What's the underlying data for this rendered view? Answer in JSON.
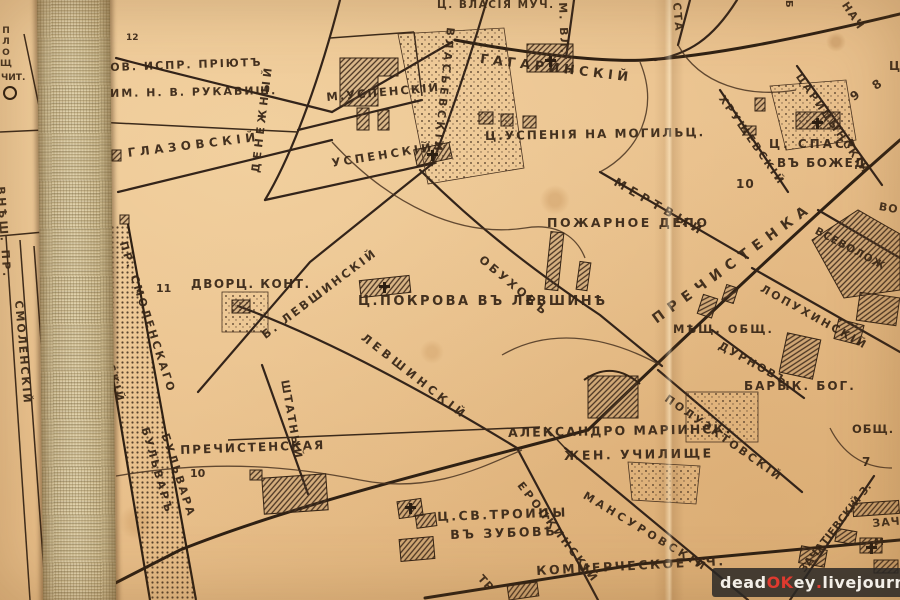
{
  "map": {
    "kind": "historical-city-map-scan",
    "ink_color": "#32230f",
    "paper_color": "#e9c08c",
    "cloth_color": "#cdbb91",
    "labels": [
      {
        "n": "street-label-gagarinsky",
        "t": "ГАГАРИНСКІЙ",
        "x": 481,
        "y": 53,
        "r": 7,
        "s": 13,
        "sp": 4.5
      },
      {
        "n": "church-label-vlasiya",
        "t": "Ц. ВЛАСІЯ МУЧ.",
        "x": 437,
        "y": 0,
        "r": 0,
        "s": 10.5,
        "sp": 1.5
      },
      {
        "n": "street-label-vlasyevsky",
        "t": "ВЛАСЬЕВСКІЙ",
        "x": 456,
        "y": 28,
        "r": 96,
        "s": 11,
        "sp": 3.5
      },
      {
        "n": "street-label-m-vlasyevsky",
        "t": "М. ВЛ.",
        "x": 568,
        "y": 2,
        "r": 88,
        "s": 11,
        "sp": 2
      },
      {
        "n": "street-label-sta-partial",
        "t": "СТА",
        "x": 682,
        "y": 2,
        "r": 85,
        "s": 11,
        "sp": 2
      },
      {
        "n": "street-label-nach-partial",
        "t": "НАЧ",
        "x": 849,
        "y": 0,
        "r": 56,
        "s": 11,
        "sp": 1.5
      },
      {
        "n": "street-label-b-partial",
        "t": "Б",
        "x": 793,
        "y": 0,
        "r": 90,
        "s": 10,
        "sp": 0
      },
      {
        "n": "label-ts-partial",
        "t": "Ц",
        "x": 889,
        "y": 60,
        "r": 0,
        "s": 12,
        "sp": 0
      },
      {
        "n": "label-priyut-line1",
        "t": "ОВ. ИСПР. ПРІЮТЪ",
        "x": 110,
        "y": 62,
        "r": -2,
        "s": 11,
        "sp": 2
      },
      {
        "n": "label-priyut-line2",
        "t": "ИМ. Н. В. РУКАВИШ.",
        "x": 110,
        "y": 88,
        "r": -1,
        "s": 11,
        "sp": 2
      },
      {
        "n": "block-number-12",
        "t": "12",
        "x": 126,
        "y": 34,
        "r": 0,
        "s": 9,
        "sp": 0
      },
      {
        "n": "label-ploshch-partial",
        "t": "ПЛОЩ",
        "x": 1,
        "y": 26,
        "r": 0,
        "s": 9,
        "sp": 1,
        "up": true
      },
      {
        "n": "label-chit",
        "t": "ЧИТ.",
        "x": 1,
        "y": 74,
        "r": 0,
        "s": 9,
        "sp": 0
      },
      {
        "n": "street-label-glazovsky",
        "t": "ГЛАЗОВСКІЙ",
        "x": 127,
        "y": 147,
        "r": -7,
        "s": 12,
        "sp": 4.5
      },
      {
        "n": "street-label-denezhny",
        "t": "ДЕНЕЖНЫЙ",
        "x": 250,
        "y": 172,
        "r": -83,
        "s": 11,
        "sp": 4
      },
      {
        "n": "street-label-m-uspensky",
        "t": "М.УСПЕНСКІЙ",
        "x": 326,
        "y": 92,
        "r": -5,
        "s": 11.5,
        "sp": 2
      },
      {
        "n": "street-label-uspensky",
        "t": "УСПЕНСКІЙ",
        "x": 331,
        "y": 158,
        "r": -9,
        "s": 11.5,
        "sp": 3
      },
      {
        "n": "church-label-uspeniya",
        "t": "Ц.УСПЕНІЯ НА МОГИЛЬЦ.",
        "x": 485,
        "y": 130,
        "r": -1,
        "s": 12,
        "sp": 2
      },
      {
        "n": "street-label-tsaritsynsky",
        "t": "ЦАРИЦЫНСКІЙ",
        "x": 802,
        "y": 72,
        "r": 55,
        "s": 10.5,
        "sp": 2.5
      },
      {
        "n": "street-label-khrushchevsky",
        "t": "ХРУЩЕВСКІЙ",
        "x": 725,
        "y": 94,
        "r": 55,
        "s": 10.5,
        "sp": 2.5
      },
      {
        "n": "street-label-mertvy",
        "t": "МЕРТВЫЙ",
        "x": 618,
        "y": 176,
        "r": 30,
        "s": 12,
        "sp": 5
      },
      {
        "n": "church-label-spasa-line1",
        "t": "Ц. СПАСА",
        "x": 769,
        "y": 138,
        "r": 0,
        "s": 12,
        "sp": 3
      },
      {
        "n": "church-label-spasa-line2",
        "t": "ВЪ БОЖЕД.",
        "x": 777,
        "y": 157,
        "r": 0,
        "s": 12,
        "sp": 1.5
      },
      {
        "n": "block-number-10a",
        "t": "10",
        "x": 736,
        "y": 178,
        "r": 0,
        "s": 12,
        "sp": 1
      },
      {
        "n": "block-number-9",
        "t": "9",
        "x": 848,
        "y": 93,
        "r": -35,
        "s": 12,
        "sp": 0
      },
      {
        "n": "block-number-8",
        "t": "8",
        "x": 870,
        "y": 82,
        "r": -35,
        "s": 12,
        "sp": 0
      },
      {
        "n": "label-pozharnoe-depo",
        "t": "ПОЖАРНОЕ ДЕПО",
        "x": 547,
        "y": 217,
        "r": 0,
        "s": 12.5,
        "sp": 2.5
      },
      {
        "n": "street-label-obukhov",
        "t": "ОБУХОВЪ",
        "x": 484,
        "y": 254,
        "r": 40,
        "s": 11.5,
        "sp": 3
      },
      {
        "n": "street-label-prechistenka",
        "t": "ПРЕЧИСТЕНКА",
        "x": 650,
        "y": 315,
        "r": -36,
        "s": 14,
        "sp": 7
      },
      {
        "n": "street-label-vsevolozh",
        "t": "ВСЕВОЛОЖ",
        "x": 818,
        "y": 226,
        "r": 28,
        "s": 10.5,
        "sp": 1
      },
      {
        "n": "label-vo-partial",
        "t": "ВО",
        "x": 880,
        "y": 201,
        "r": 10,
        "s": 11,
        "sp": 1
      },
      {
        "n": "street-label-lopukhinsky",
        "t": "ЛОПУХИНСКІЙ",
        "x": 764,
        "y": 283,
        "r": 29,
        "s": 11,
        "sp": 2.5
      },
      {
        "n": "label-meshch-obshch",
        "t": "МѢЩ. ОБЩ.",
        "x": 673,
        "y": 324,
        "r": 0,
        "s": 11.5,
        "sp": 2
      },
      {
        "n": "street-label-durnov",
        "t": "ДУРНОВЪ",
        "x": 722,
        "y": 340,
        "r": 29,
        "s": 11,
        "sp": 2
      },
      {
        "n": "label-baryk-bog",
        "t": "БАРЫК. БОГ.",
        "x": 744,
        "y": 380,
        "r": 0,
        "s": 12,
        "sp": 2
      },
      {
        "n": "street-label-b-levshinsky",
        "t": "Б. ЛЕВШИНСКІЙ",
        "x": 260,
        "y": 332,
        "r": -37,
        "s": 11.5,
        "sp": 2.5
      },
      {
        "n": "label-dvorts-kont",
        "t": "ДВОРЦ. КОНТ.",
        "x": 191,
        "y": 278,
        "r": 0,
        "s": 12,
        "sp": 1.5
      },
      {
        "n": "block-number-11",
        "t": "11",
        "x": 156,
        "y": 283,
        "r": 0,
        "s": 11,
        "sp": 0
      },
      {
        "n": "church-label-pokrova",
        "t": "Ц.ПОКРОВА ВЪ ЛЕВШИНѢ",
        "x": 358,
        "y": 295,
        "r": 0,
        "s": 13,
        "sp": 2.5
      },
      {
        "n": "street-label-levshinsky",
        "t": "ЛЕВШИНСКІЙ",
        "x": 366,
        "y": 332,
        "r": 38,
        "s": 11.5,
        "sp": 4
      },
      {
        "n": "street-label-shtatny",
        "t": "ШТАТНЫЙ",
        "x": 290,
        "y": 379,
        "r": 80,
        "s": 11,
        "sp": 2
      },
      {
        "n": "label-prechistenskaya",
        "t": "ПРЕЧИСТЕНСКАЯ",
        "x": 180,
        "y": 444,
        "r": -2,
        "s": 12,
        "sp": 2
      },
      {
        "n": "block-number-10b",
        "t": "10",
        "x": 190,
        "y": 468,
        "r": 0,
        "s": 11,
        "sp": 0
      },
      {
        "n": "label-aleksandro-mariinsk",
        "t": "АЛЕКСАНДРО МАРІИНСК.",
        "x": 508,
        "y": 427,
        "r": -1,
        "s": 12.5,
        "sp": 2
      },
      {
        "n": "label-zhen-uchilishche",
        "t": "ЖЕН. УЧИЛИЩЕ",
        "x": 564,
        "y": 450,
        "r": -1,
        "s": 12.5,
        "sp": 2.5
      },
      {
        "n": "street-label-poluektovsky",
        "t": "ПОЛУЭКТОВСКІЙ",
        "x": 669,
        "y": 393,
        "r": 35,
        "s": 11,
        "sp": 2.5
      },
      {
        "n": "label-obshch-p-partial",
        "t": "ОБЩ. П",
        "x": 852,
        "y": 424,
        "r": 0,
        "s": 11.5,
        "sp": 1
      },
      {
        "n": "block-number-7",
        "t": "7",
        "x": 862,
        "y": 456,
        "r": 0,
        "s": 12,
        "sp": 0
      },
      {
        "n": "church-label-troitsy-line1",
        "t": "Ц.СВ.ТРОИЦЫ",
        "x": 437,
        "y": 511,
        "r": -2,
        "s": 12.5,
        "sp": 2.5
      },
      {
        "n": "church-label-troitsy-line2",
        "t": "ВЪ ЗУБОВѢ",
        "x": 450,
        "y": 529,
        "r": -2,
        "s": 12.5,
        "sp": 2.5
      },
      {
        "n": "street-label-eropkinsky",
        "t": "ЕРОПКИНСКІЙ",
        "x": 524,
        "y": 480,
        "r": 52,
        "s": 11,
        "sp": 3
      },
      {
        "n": "street-label-mansurovsky",
        "t": "МАНСУРОВСКІЙ",
        "x": 587,
        "y": 490,
        "r": 31,
        "s": 11,
        "sp": 3.5
      },
      {
        "n": "label-kommercheskoe",
        "t": "КОММЕРЧЕСКОЕ УЧ.",
        "x": 536,
        "y": 565,
        "r": -3,
        "s": 12.5,
        "sp": 2.5
      },
      {
        "n": "street-label-tr-partial",
        "t": "ТР",
        "x": 484,
        "y": 573,
        "r": 48,
        "s": 11,
        "sp": 1
      },
      {
        "n": "street-label-zachatievsky",
        "t": "ЗАЧАТІЕВСКІЙ З.",
        "x": 798,
        "y": 568,
        "r": -52,
        "s": 10.5,
        "sp": 0.5
      },
      {
        "n": "label-zacha-partial",
        "t": "ЗАЧА",
        "x": 872,
        "y": 518,
        "r": -5,
        "s": 11,
        "sp": 1
      },
      {
        "n": "label-m-partial",
        "t": "М",
        "x": 874,
        "y": 538,
        "r": 0,
        "s": 10,
        "sp": 0
      },
      {
        "n": "street-label-pr-smolenskogo",
        "t": "ПР. СМОЛЕНСКАГО",
        "x": 128,
        "y": 240,
        "r": 72,
        "s": 11,
        "sp": 2.5
      },
      {
        "n": "street-label-bulvara",
        "t": "БУЛЬВАРА",
        "x": 170,
        "y": 432,
        "r": 72,
        "s": 11,
        "sp": 2.5
      },
      {
        "n": "street-label-smolensky-strip",
        "t": "СМОЛЕНСКІЙ",
        "x": 96,
        "y": 296,
        "r": 74,
        "s": 11,
        "sp": 2.5
      },
      {
        "n": "street-label-bulvar-strip",
        "t": "БУЛЬВАРЪ",
        "x": 150,
        "y": 426,
        "r": 74,
        "s": 11,
        "sp": 2.5
      },
      {
        "n": "street-label-smolensky-left",
        "t": "СМОЛЕНСКІЙ",
        "x": 24,
        "y": 300,
        "r": 85,
        "s": 11,
        "sp": 2
      },
      {
        "n": "street-label-vnesh-pr",
        "t": "ВНѢШ. ПР.",
        "x": 6,
        "y": 186,
        "r": 86,
        "s": 11,
        "sp": 2.5
      }
    ],
    "symbols": {
      "church_crosses": [
        {
          "x": 549,
          "y": 56
        },
        {
          "x": 431,
          "y": 150
        },
        {
          "x": 383,
          "y": 282
        },
        {
          "x": 816,
          "y": 118
        },
        {
          "x": 409,
          "y": 503
        },
        {
          "x": 870,
          "y": 543
        }
      ],
      "reading_circle": {
        "x": 3,
        "y": 86
      }
    }
  },
  "watermark": {
    "segments": [
      {
        "text": "dead",
        "color": "#f3efe8"
      },
      {
        "text": "OK",
        "color": "#e03a2f"
      },
      {
        "text": "ey",
        "color": "#f3efe8"
      },
      {
        "text": ".",
        "color": "#e03a2f"
      },
      {
        "text": "livejournal",
        "color": "#f3efe8"
      },
      {
        "text": ".",
        "color": "#e03a2f"
      },
      {
        "text": "com",
        "color": "#f3efe8"
      }
    ]
  }
}
